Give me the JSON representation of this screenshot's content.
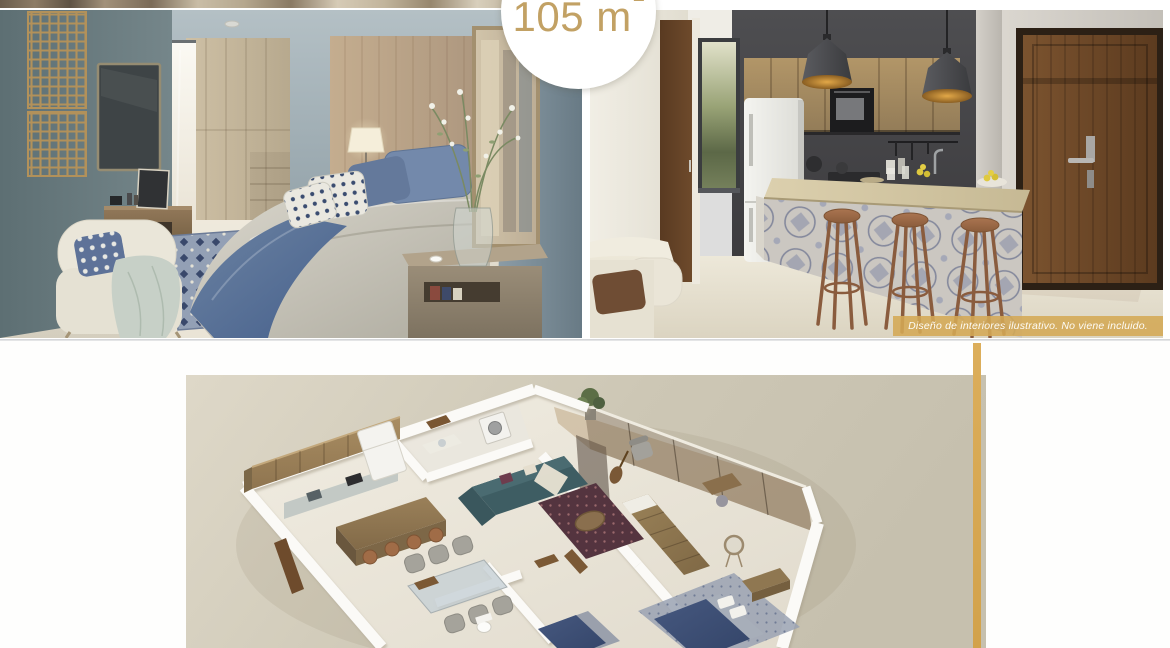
{
  "badge": {
    "area_text": "105 m",
    "area_superscript": "2"
  },
  "kitchen_photo": {
    "disclaimer": "Diseño de interiores ilustrativo. No viene incluido."
  },
  "colors": {
    "accent_gold": "#C2A164",
    "banner_gold": "#D4A955",
    "side_stripe_gold": "#D5A751",
    "floorplan_panel_beige": "#D2CCBA",
    "page_background": "#FFFFFF"
  }
}
